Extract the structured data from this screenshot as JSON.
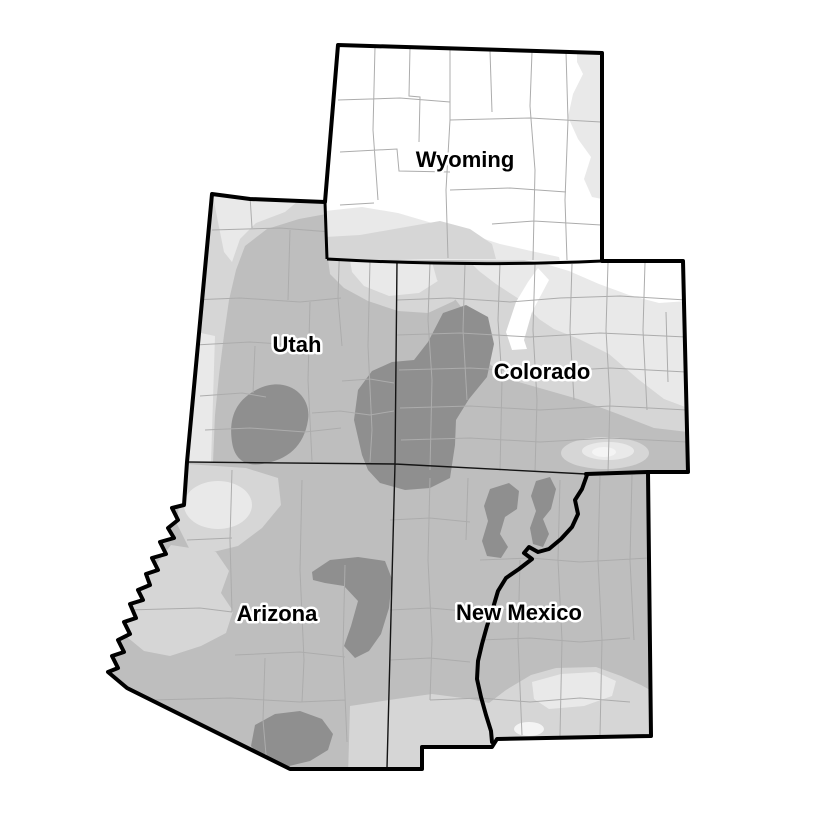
{
  "map": {
    "states": [
      {
        "id": "wyoming",
        "label": "Wyoming"
      },
      {
        "id": "utah",
        "label": "Utah"
      },
      {
        "id": "colorado",
        "label": "Colorado"
      },
      {
        "id": "arizona",
        "label": "Arizona"
      },
      {
        "id": "new-mexico",
        "label": "New Mexico"
      }
    ],
    "colors": {
      "background": "#FFFFFF",
      "shade_none": "#FFFFFF",
      "shade_light": "#E9E9E9",
      "shade_medium_light": "#D6D6D6",
      "shade_medium": "#BEBEBE",
      "shade_dark": "#8F8F8F",
      "shade_bright_spot": "#F4F4F4",
      "county_line": "#ACACAC",
      "state_border": "#141414",
      "region_outline": "#000000"
    }
  }
}
